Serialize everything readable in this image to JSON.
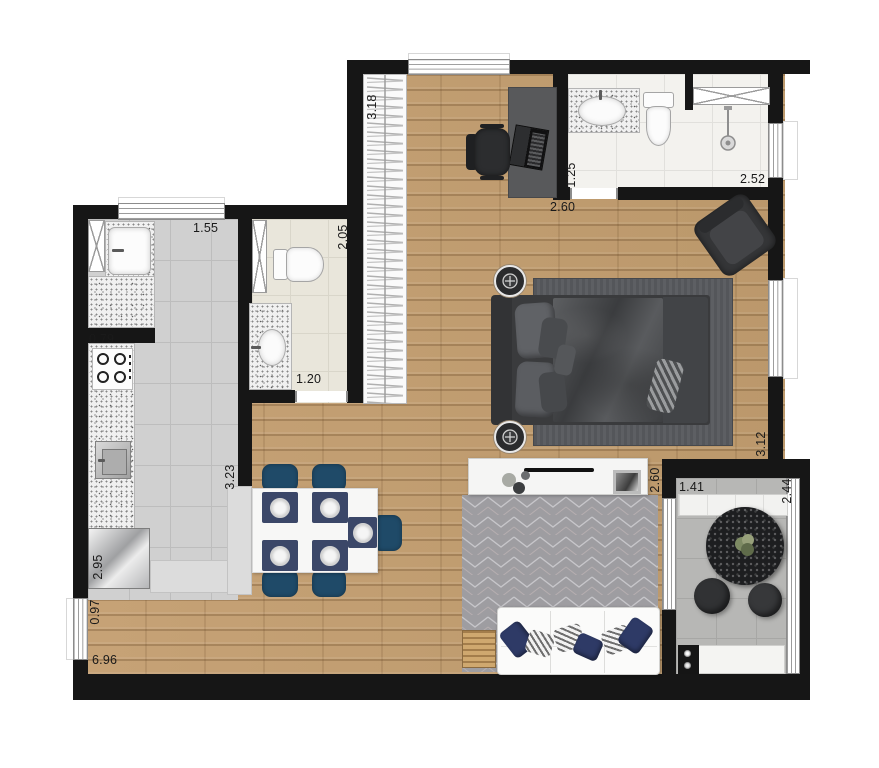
{
  "title": "apartment-floor-plan",
  "dimensions": {
    "laundry_width": "1.55",
    "bath_social_length": "2.05",
    "bath_social_door": "1.20",
    "kitchen_stove": "0.79",
    "kitchen_counter": "2.95",
    "hall_width": "0.97",
    "living_length": "6.96",
    "kitchen_wall": "3.23",
    "closet_length": "3.18",
    "suite_desk_wall": "2.60",
    "bath_suite_width": "1.25",
    "bath_suite_length": "2.52",
    "bedroom_window": "3.12",
    "balcony_door": "2.60",
    "balcony_width": "1.41",
    "balcony_length": "2.44"
  },
  "colors": {
    "wall": "#161616",
    "wood_floor": "#c29e72",
    "gray_tile": "#d0d0d0",
    "beige_tile": "#e9e6db",
    "balcony_tile": "#b7b7b5",
    "chair_navy": "#1f4a68",
    "placemat_navy": "#3b4768",
    "rug_gray": "#9e9da1",
    "bed_dark": "#4b4d50",
    "sofa_white": "#fbfbfa"
  },
  "icons": [
    "lamp-icon",
    "shower-head-icon",
    "burner-icon",
    "plant-icon",
    "hanger-icon",
    "faucet-icon",
    "knob-icon"
  ]
}
